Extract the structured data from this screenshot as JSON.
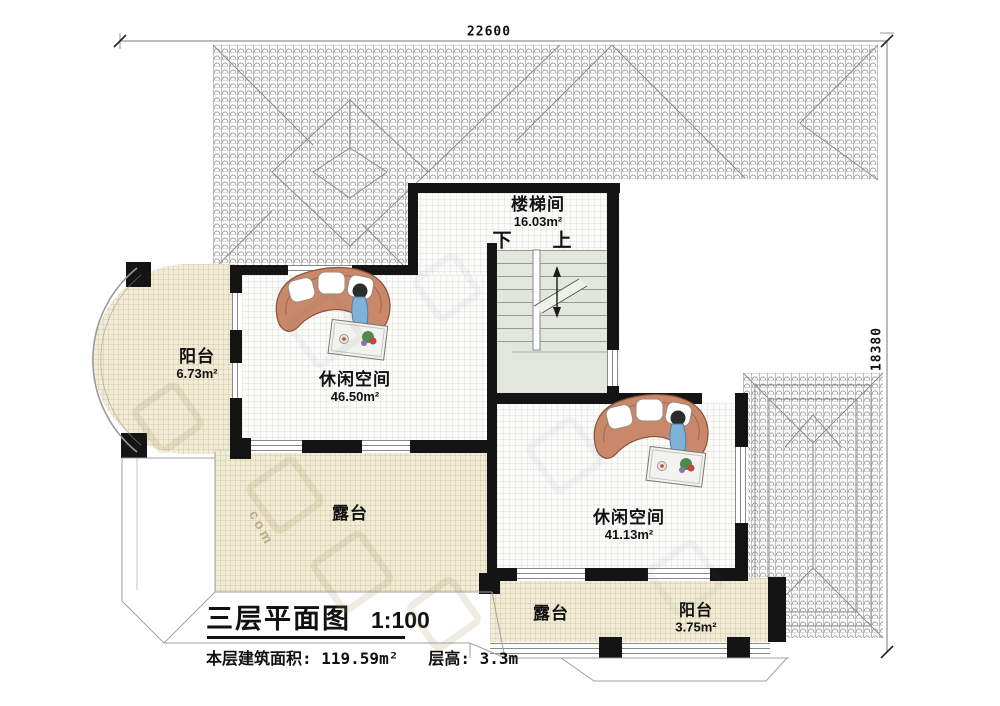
{
  "dimensions": {
    "width": "22600",
    "height": "18380"
  },
  "rooms": {
    "stairwell": {
      "name": "楼梯间",
      "area": "16.03m²"
    },
    "balcony_left": {
      "name": "阳台",
      "area": "6.73m²"
    },
    "leisure_left": {
      "name": "休闲空间",
      "area": "46.50m²"
    },
    "terrace_left": {
      "name": "露台"
    },
    "leisure_right": {
      "name": "休闲空间",
      "area": "41.13m²"
    },
    "terrace_bottom": {
      "name": "露台"
    },
    "balcony_bottom": {
      "name": "阳台",
      "area": "3.75m²"
    }
  },
  "stairs": {
    "down": "下",
    "up": "上"
  },
  "title_block": {
    "title": "三层平面图",
    "scale": "1:100",
    "floor_area": "本层建筑面积: 119.59m²",
    "floor_height": "层高: 3.3m"
  },
  "watermark": {
    "text": "com"
  },
  "colors": {
    "wall": "#141414",
    "terrace_fill": "#f2ecd7",
    "stairs_fill": "#e2e6dd",
    "sofa": "#c9886a",
    "figure_dress": "#7fb2d6"
  }
}
